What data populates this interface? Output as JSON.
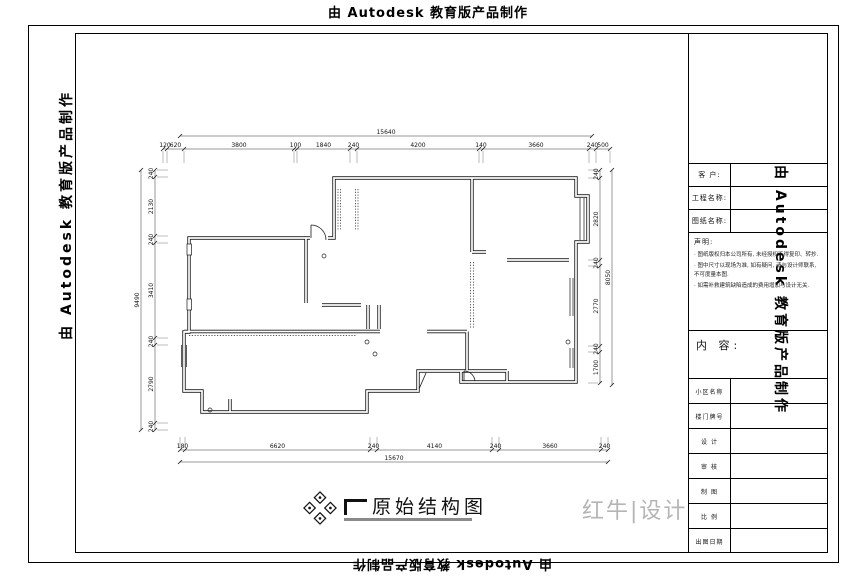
{
  "watermark": {
    "text": "由 Autodesk 教育版产品制作"
  },
  "title_block": {
    "client_label": "客  户:",
    "project_label": "工程名称:",
    "drawing_label": "图纸名称:",
    "statement_title": "声明:",
    "statement_items": [
      "图纸版权归本公司所有, 未经授权不得复印、转抄.",
      "图中尺寸以现场为准, 如有疑问, 请与设计师联系, 不可度量本图.",
      "如需补救建筑缺陷造成的费用增加与设计无关."
    ],
    "content_label": "内 容:",
    "info_rows": [
      "小区名称",
      "楼门牌号",
      "设  计",
      "审  核",
      "制  图",
      "比  例",
      "出图日期"
    ]
  },
  "caption": {
    "title": "原始结构图"
  },
  "brand": {
    "logo_text": "红牛|设计"
  },
  "dimensions": {
    "top": {
      "overall": "15640",
      "segments": [
        "120",
        "620",
        "3800",
        "100",
        "1840",
        "240",
        "4200",
        "140",
        "3660",
        "240",
        "500"
      ]
    },
    "bottom": {
      "overall": "15670",
      "segments": [
        "180",
        "6620",
        "240",
        "4140",
        "240",
        "3660",
        "240"
      ]
    },
    "left": {
      "overall": "9490",
      "segments": [
        "240",
        "2130",
        "240",
        "3410",
        "240",
        "2790",
        "240"
      ]
    },
    "right": {
      "overall": "8050",
      "segments": [
        "240",
        "2820",
        "240",
        "2770",
        "240",
        "1700"
      ]
    }
  }
}
